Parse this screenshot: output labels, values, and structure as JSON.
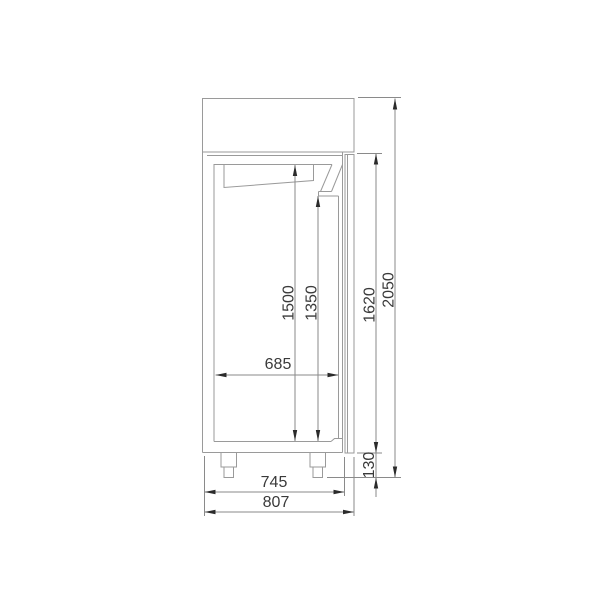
{
  "drawing": {
    "dimensions": {
      "total_height": "2050",
      "door_height": "1620",
      "leg_height": "130",
      "interior_height": "1500",
      "interior_front_height": "1350",
      "interior_depth": "685",
      "body_depth": "745",
      "total_depth": "807"
    },
    "colors": {
      "background": "#ffffff",
      "cabinet_line": "#9a9a9a",
      "dimension_line": "#8a8a8a",
      "label_text": "#3a3a3a",
      "arrowhead": "#2b2b2b"
    }
  }
}
